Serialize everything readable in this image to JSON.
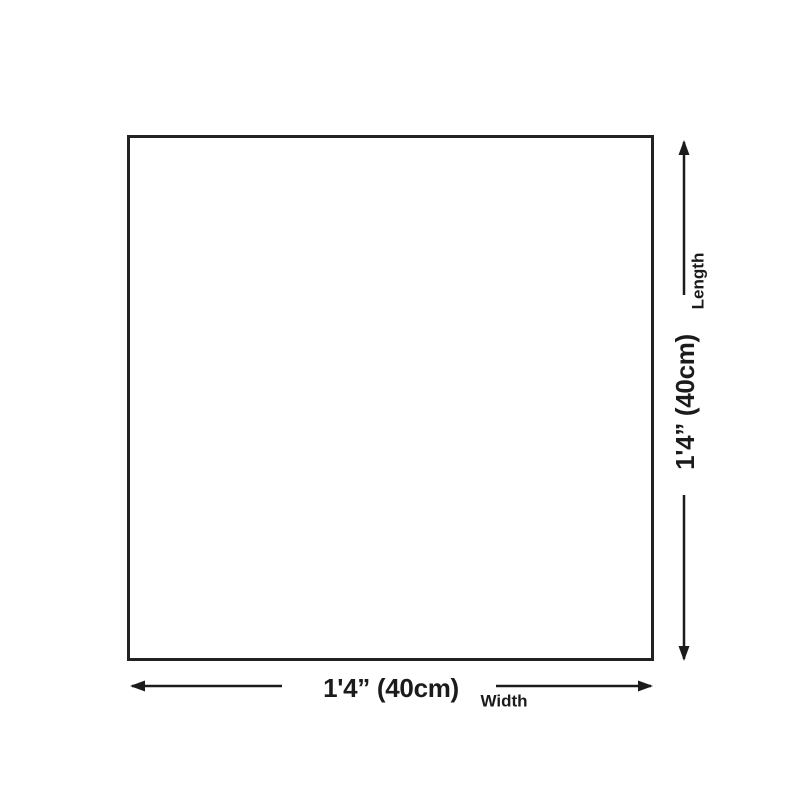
{
  "colors": {
    "background": "#ffffff",
    "line": "#1b1b1b",
    "outline": "#222222",
    "text": "#1b1b1b"
  },
  "dimension_diagram": {
    "shape": "square-outline",
    "width": {
      "value": "1'4” (40cm)",
      "axis_label": "Width"
    },
    "length": {
      "value": "1'4” (40cm)",
      "axis_label": "Length"
    }
  }
}
